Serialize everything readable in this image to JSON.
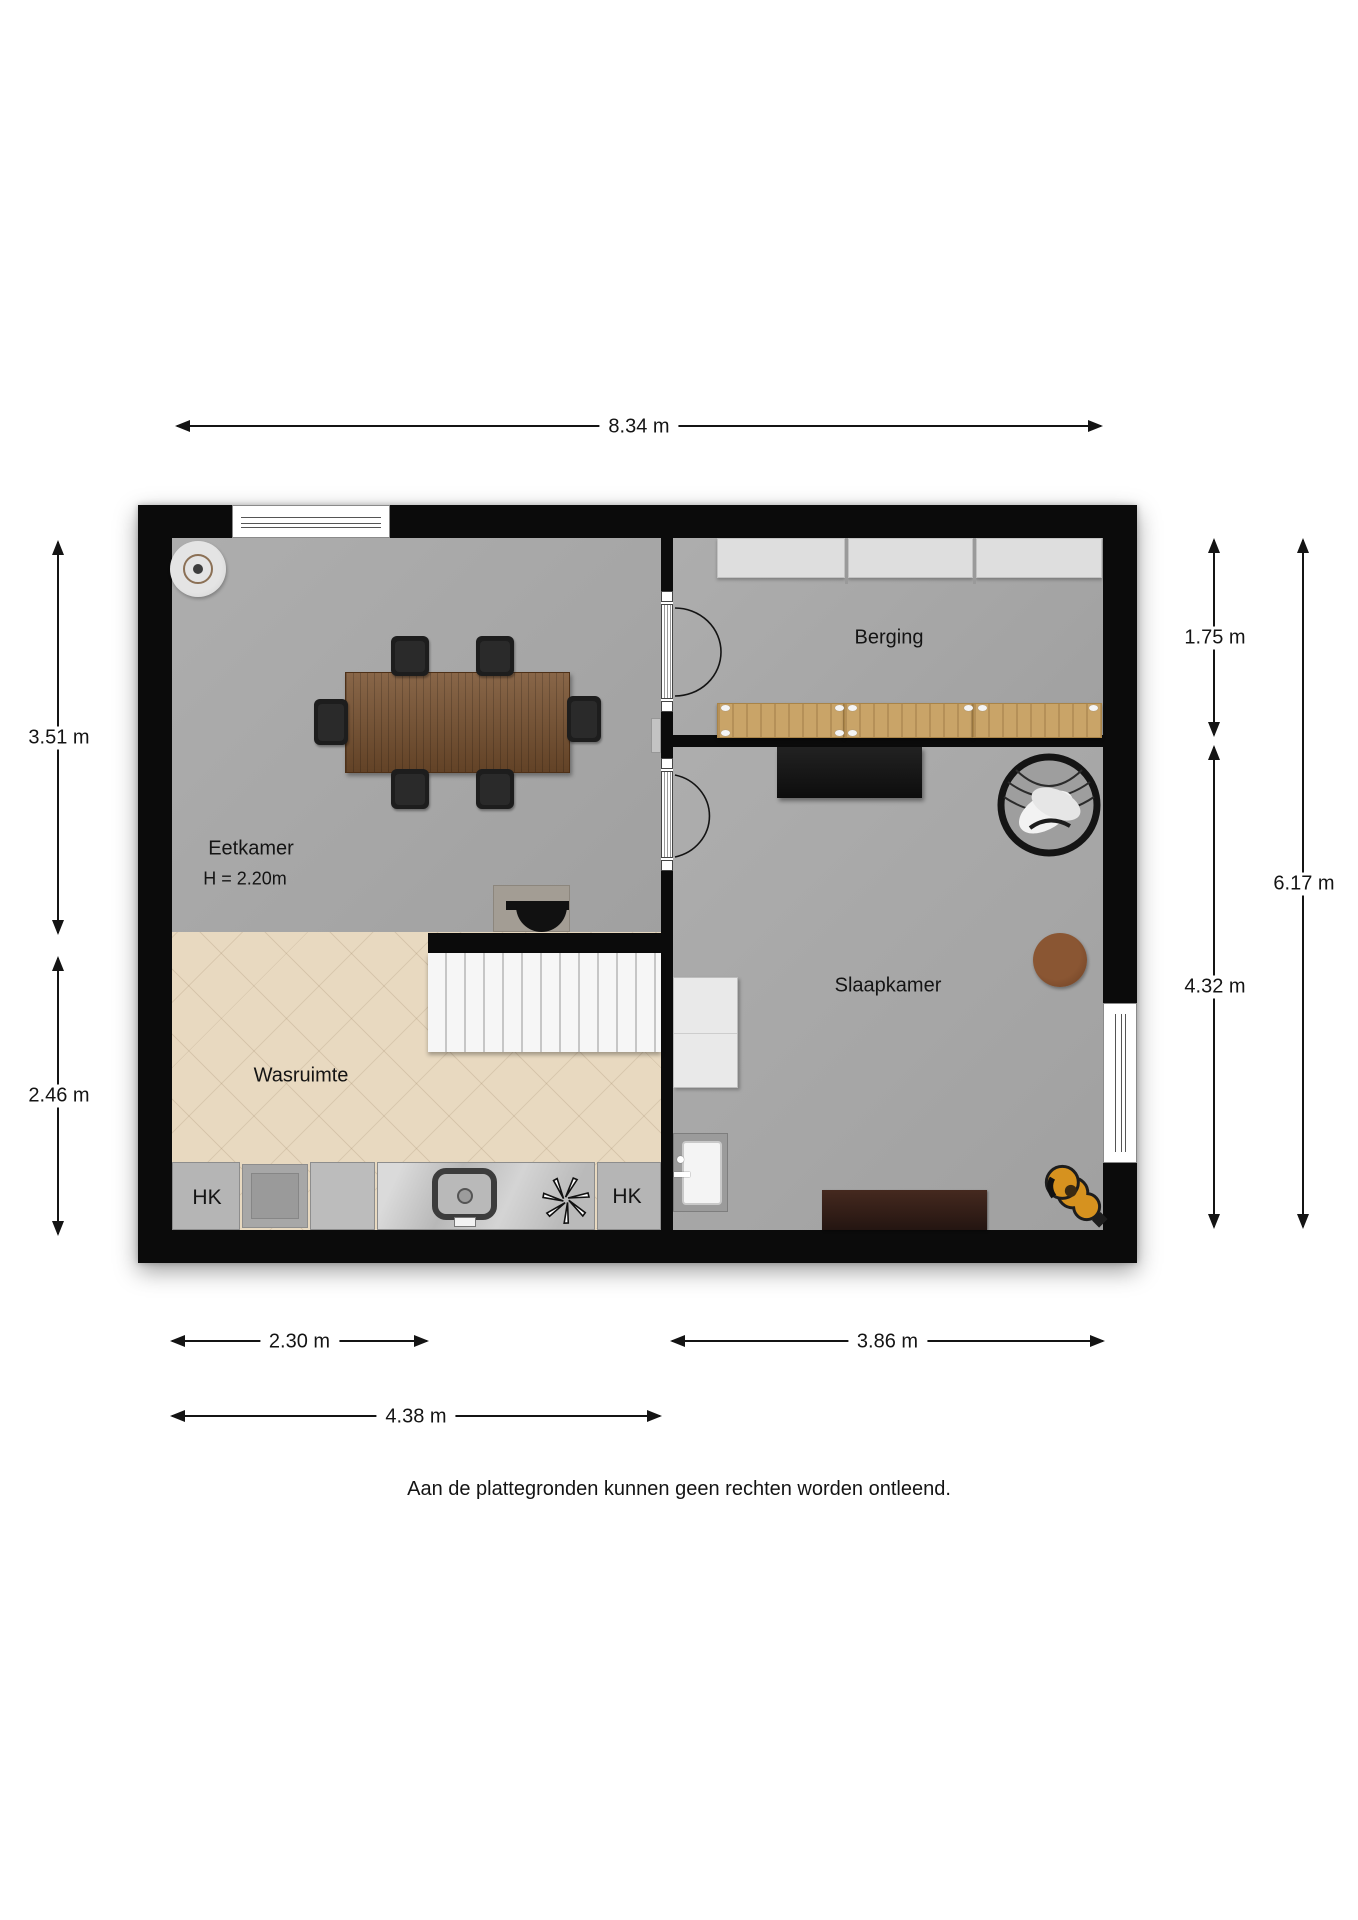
{
  "plan": {
    "rooms": {
      "eetkamer": {
        "label": "Eetkamer",
        "height_label": "H = 2.20m"
      },
      "berging": {
        "label": "Berging"
      },
      "slaapkamer": {
        "label": "Slaapkamer"
      },
      "wasruimte": {
        "label": "Wasruimte"
      },
      "closet_left": {
        "label": "HK"
      },
      "closet_right": {
        "label": "HK"
      }
    },
    "dimensions": {
      "total_width": "8.34 m",
      "eetkamer_height": "3.51 m",
      "wasruimte_height": "2.46 m",
      "berging_height": "1.75 m",
      "total_height": "6.17 m",
      "slaapkamer_height": "4.32 m",
      "wasruimte_width": "2.30 m",
      "slaapkamer_width": "3.86 m",
      "eetkamer_width": "4.38 m"
    },
    "disclaimer": "Aan de plattegronden kunnen geen rechten worden ontleend.",
    "icons": [
      "ceiling-light-icon",
      "extractor-fan-icon",
      "sink-icon",
      "stairs-icon",
      "door-swing-icon",
      "wire-chair-icon",
      "guitar-icon"
    ],
    "colors": {
      "wall": "#0b0b0b",
      "floor_gray": "#a9a9a9",
      "floor_tile": "#e8d9c0",
      "wood_shelf": "#c9a468",
      "table_wood": "#78512f",
      "bench_brown": "#2f1d18",
      "guitar_amber": "#d6921f"
    }
  }
}
